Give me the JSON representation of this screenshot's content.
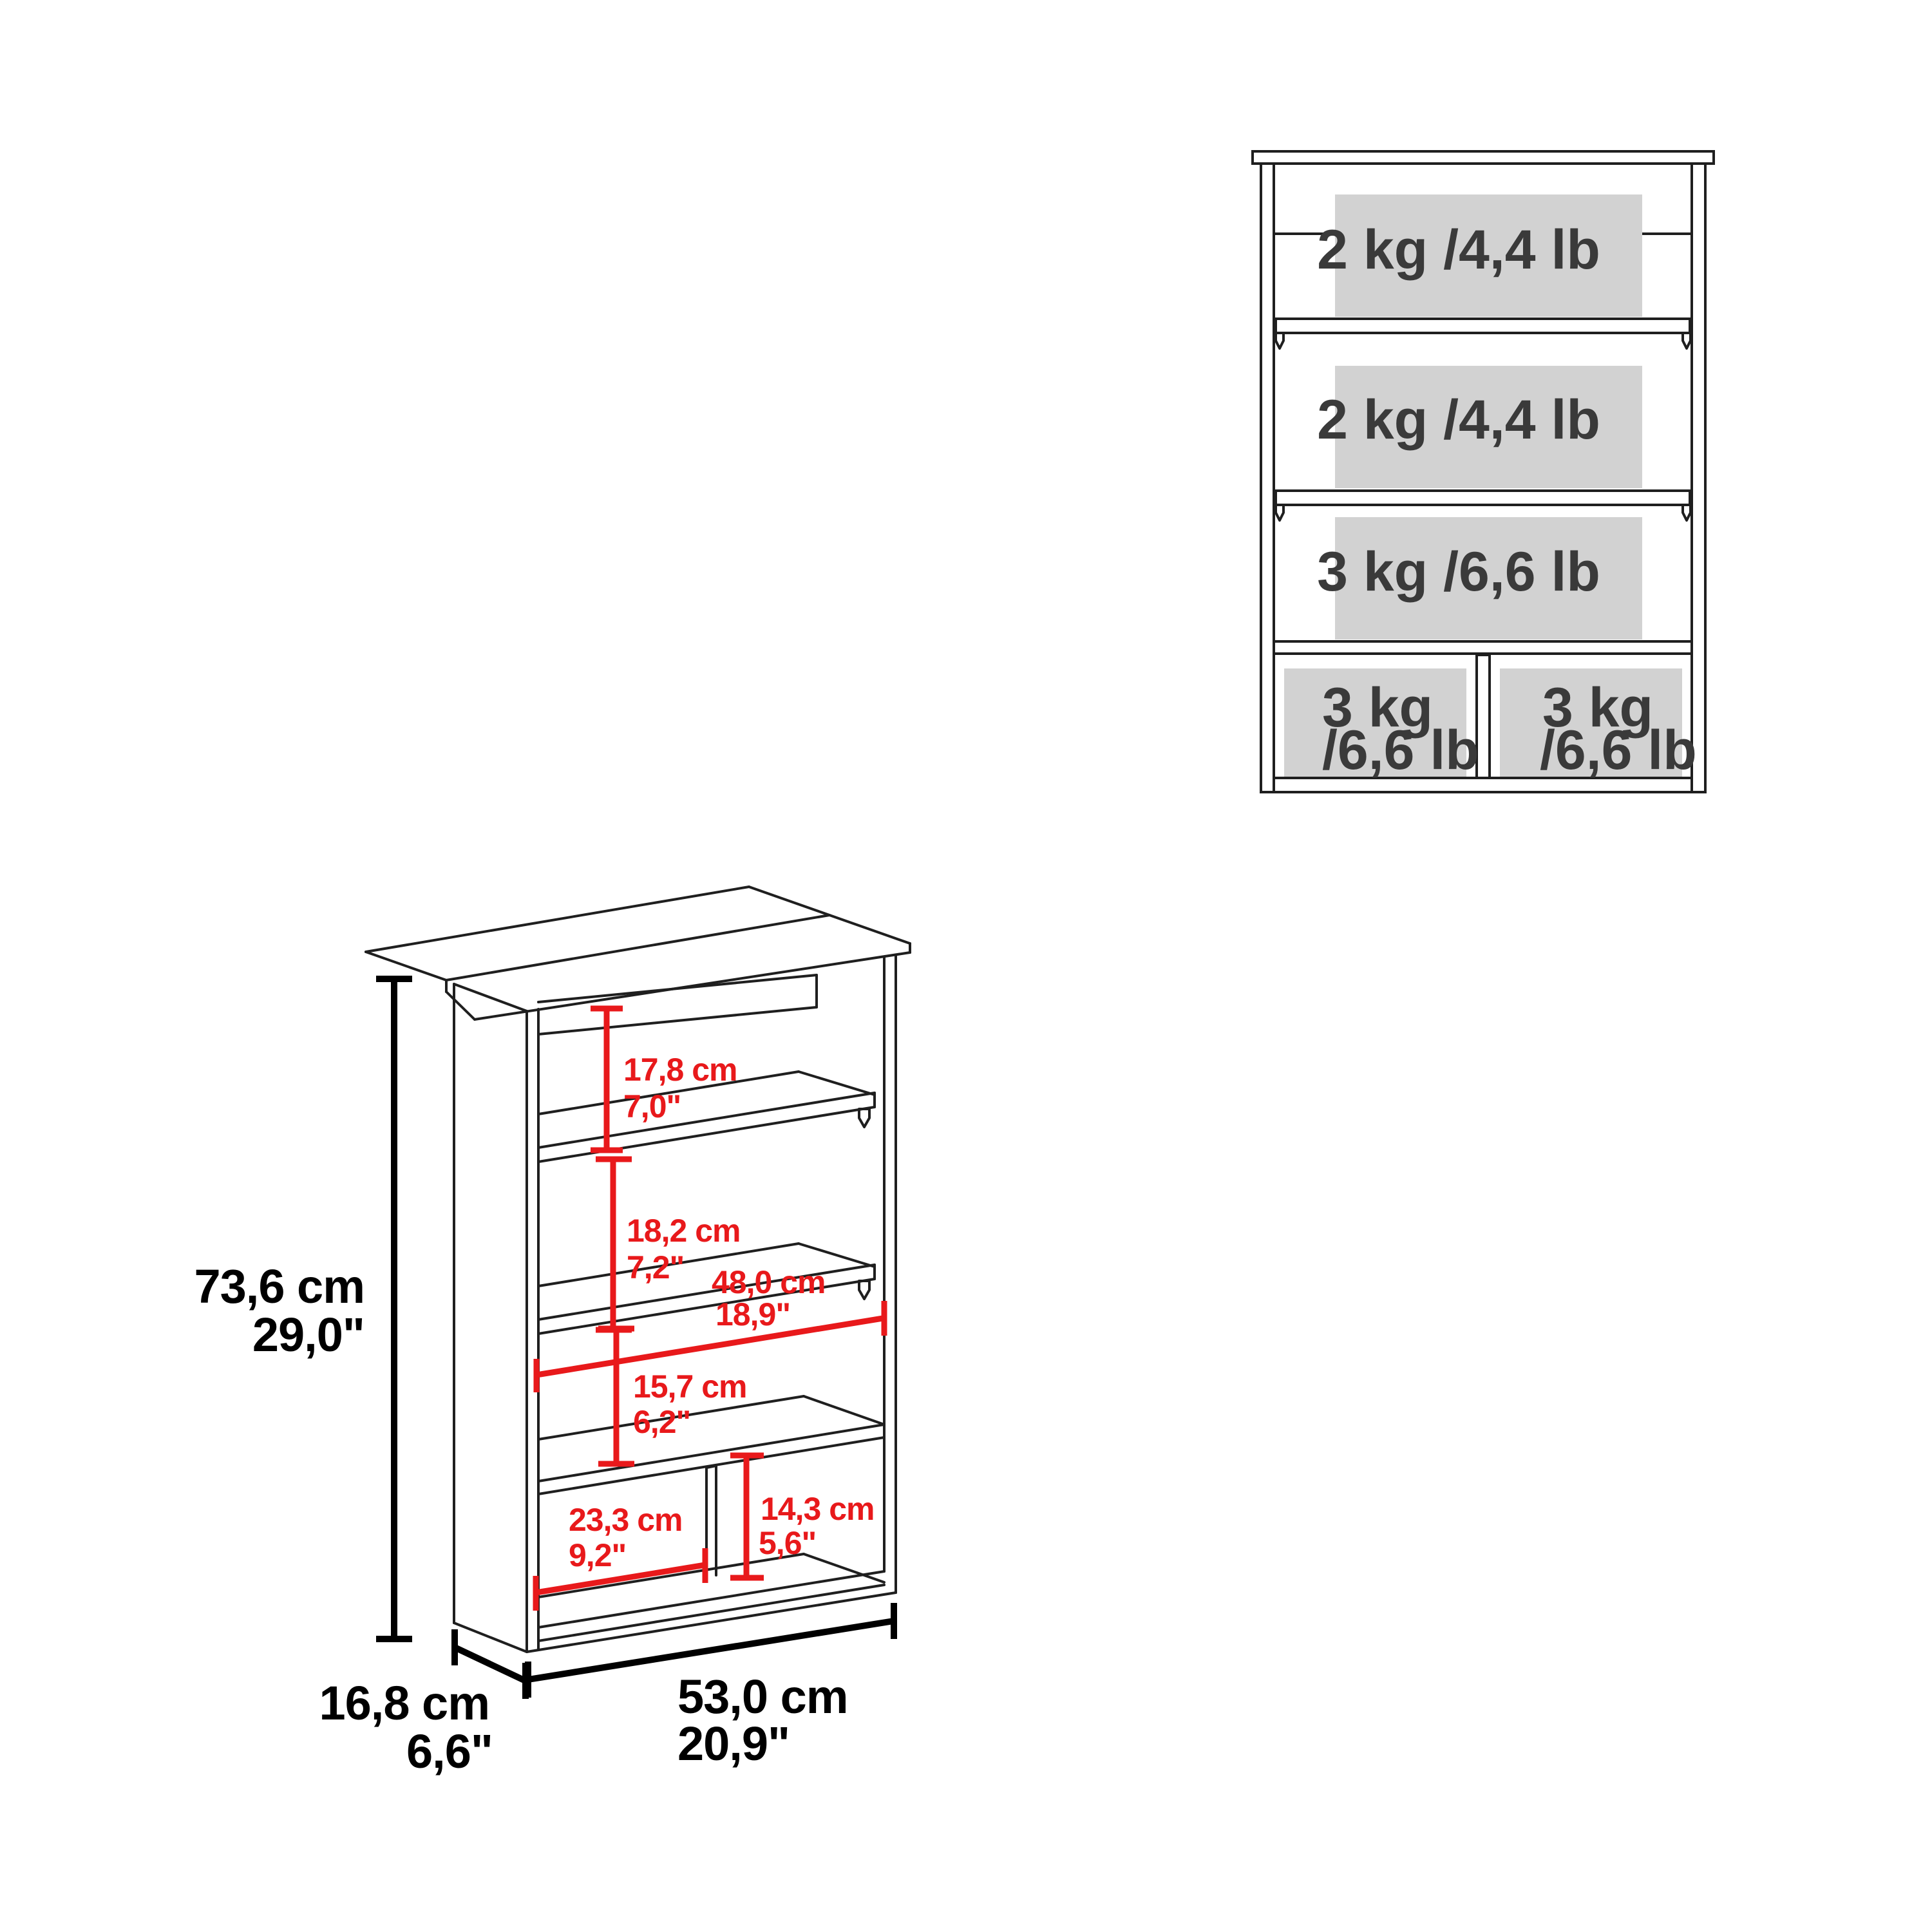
{
  "diagram": {
    "type": "furniture-dimension-diagram",
    "front_view": {
      "shelf_capacity_labels": [
        {
          "label": "2 kg /4,4 lb"
        },
        {
          "label": "2 kg /4,4 lb"
        },
        {
          "label": "3 kg /6,6 lb"
        }
      ],
      "cubby_capacity_labels": [
        {
          "line1": "3 kg",
          "line2": "/6,6 lb"
        },
        {
          "line1": "3 kg",
          "line2": "/6,6 lb"
        }
      ]
    },
    "dimension_view": {
      "height": {
        "cm": "73,6 cm",
        "in": "29,0\""
      },
      "width": {
        "cm": "53,0 cm",
        "in": "20,9\""
      },
      "depth": {
        "cm": "16,8 cm",
        "in": "6,6\""
      },
      "top_gap": {
        "cm": "17,8 cm",
        "in": "7,0\""
      },
      "middle_gap": {
        "cm": "18,2 cm",
        "in": "7,2\""
      },
      "interior_width": {
        "cm": "48,0 cm",
        "in": "18,9\""
      },
      "lower_gap": {
        "cm": "15,7 cm",
        "in": "6,2\""
      },
      "cubby_width": {
        "cm": "23,3 cm",
        "in": "9,2\""
      },
      "cubby_height": {
        "cm": "14,3 cm",
        "in": "5,6\""
      }
    },
    "colors": {
      "dimension_red": "#e8191b",
      "line_black": "#1f1f1f",
      "label_bg_gray": "#d2d2d2",
      "label_text_gray": "#3a3a3a"
    }
  }
}
